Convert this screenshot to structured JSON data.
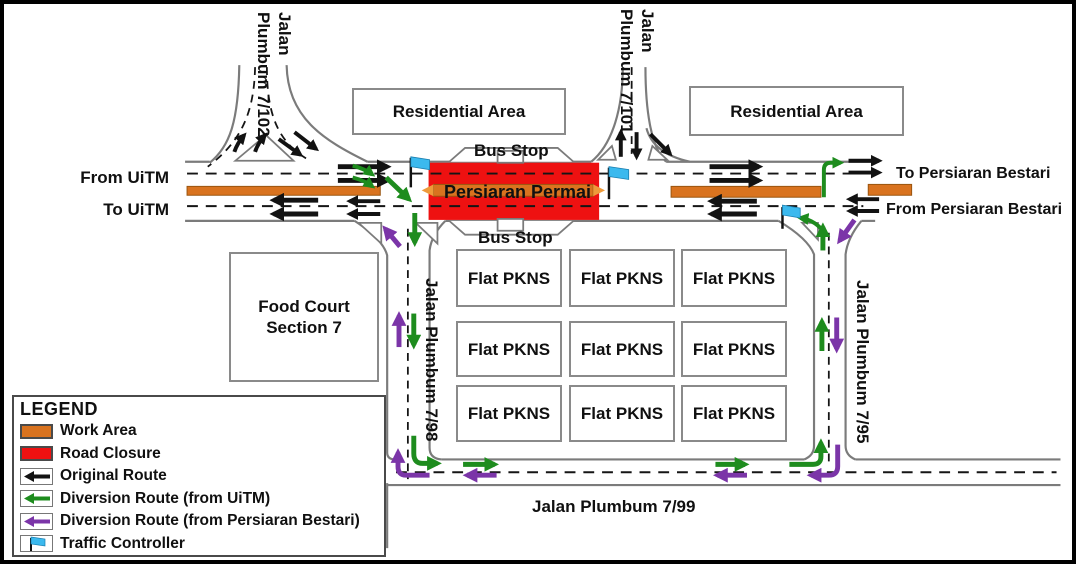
{
  "colors": {
    "work_area": "#D9731F",
    "road_closure": "#EE1111",
    "original_route": "#121212",
    "diversion_from_uitm": "#1E8C1E",
    "diversion_from_bestari": "#7B35A8",
    "traffic_controller": "#3BB9EE",
    "road_edge": "#7B7B7B"
  },
  "map": {
    "directions": {
      "from_uitm": "From UiTM",
      "to_uitm": "To UiTM",
      "to_persiaran_bestari": "To Persiaran Bestari",
      "from_persiaran_bestari": "From Persiaran Bestari"
    },
    "roads": {
      "jalan_7102": {
        "line1": "Jalan",
        "line2": "Plumbum 7/102"
      },
      "jalan_7101": {
        "line1": "Jalan",
        "line2": "Plumbum 7/101"
      },
      "jalan_798": "Jalan Plumbum 7/98",
      "jalan_795": "Jalan Plumbum 7/95",
      "jalan_799": "Jalan Plumbum 7/99",
      "closed_road": "Persiaran Permai"
    },
    "places": {
      "residential_area_1": "Residential Area",
      "residential_area_2": "Residential Area",
      "bus_stop_top": "Bus Stop",
      "bus_stop_bottom": "Bus Stop",
      "food_court_line1": "Food Court",
      "food_court_line2": "Section 7",
      "flats": [
        "Flat PKNS",
        "Flat PKNS",
        "Flat PKNS",
        "Flat PKNS",
        "Flat PKNS",
        "Flat PKNS",
        "Flat PKNS",
        "Flat PKNS",
        "Flat PKNS"
      ]
    }
  },
  "legend": {
    "title": "LEGEND",
    "items": [
      {
        "key": "work-area",
        "label": "Work Area"
      },
      {
        "key": "road-closure",
        "label": "Road Closure"
      },
      {
        "key": "original-route",
        "label": "Original Route"
      },
      {
        "key": "diversion-uitm",
        "label": "Diversion Route (from UiTM)"
      },
      {
        "key": "diversion-bestari",
        "label": "Diversion Route (from Persiaran Bestari)"
      },
      {
        "key": "traffic-controller",
        "label": "Traffic Controller"
      }
    ]
  }
}
